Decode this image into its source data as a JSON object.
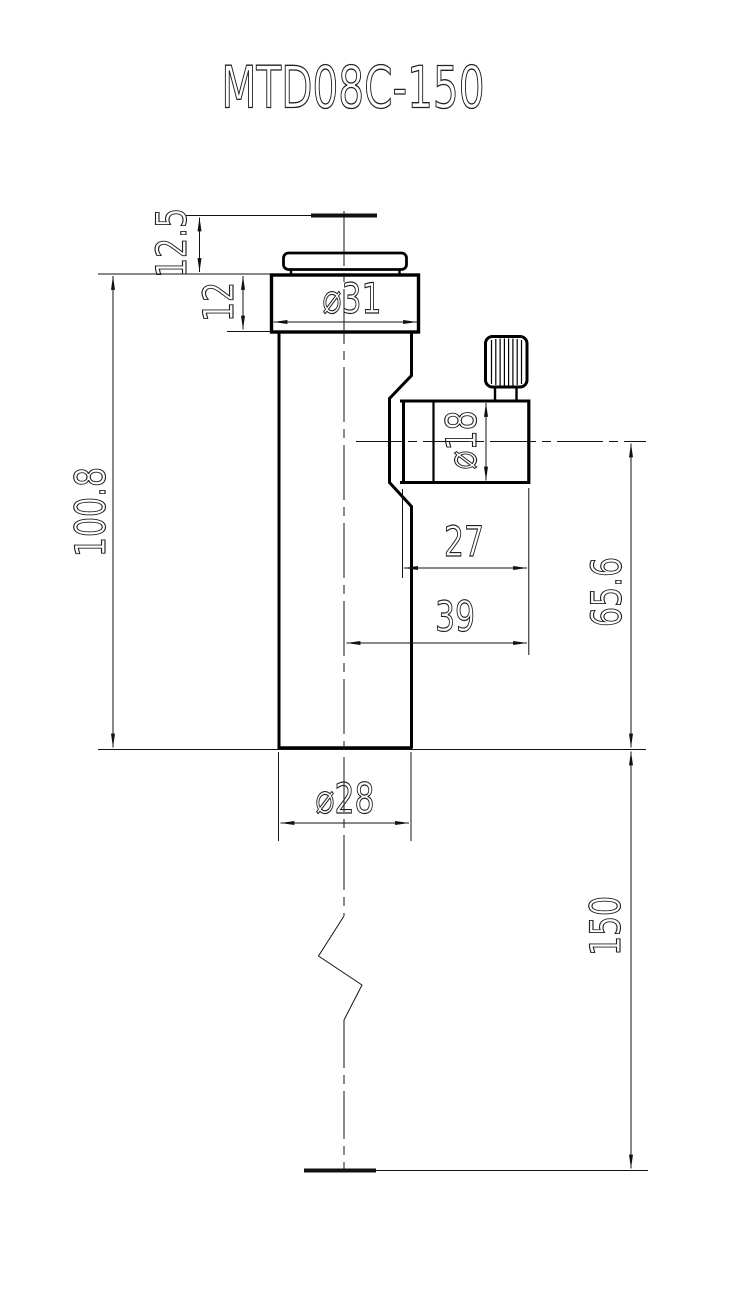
{
  "title": "MTD08C-150",
  "dimensions": {
    "top_standoff": "12.5",
    "head_height": "12",
    "head_diameter": "⌀31",
    "body_height": "100.8",
    "port_diameter": "⌀18",
    "port_face_width": "27",
    "port_axis_width": "39",
    "port_axis_height": "65.6",
    "body_diameter": "⌀28",
    "overall_height": "150"
  },
  "colors": {
    "outline": "#000000",
    "dimension_lines": "#111111",
    "text": "#222222",
    "background": "#ffffff"
  }
}
